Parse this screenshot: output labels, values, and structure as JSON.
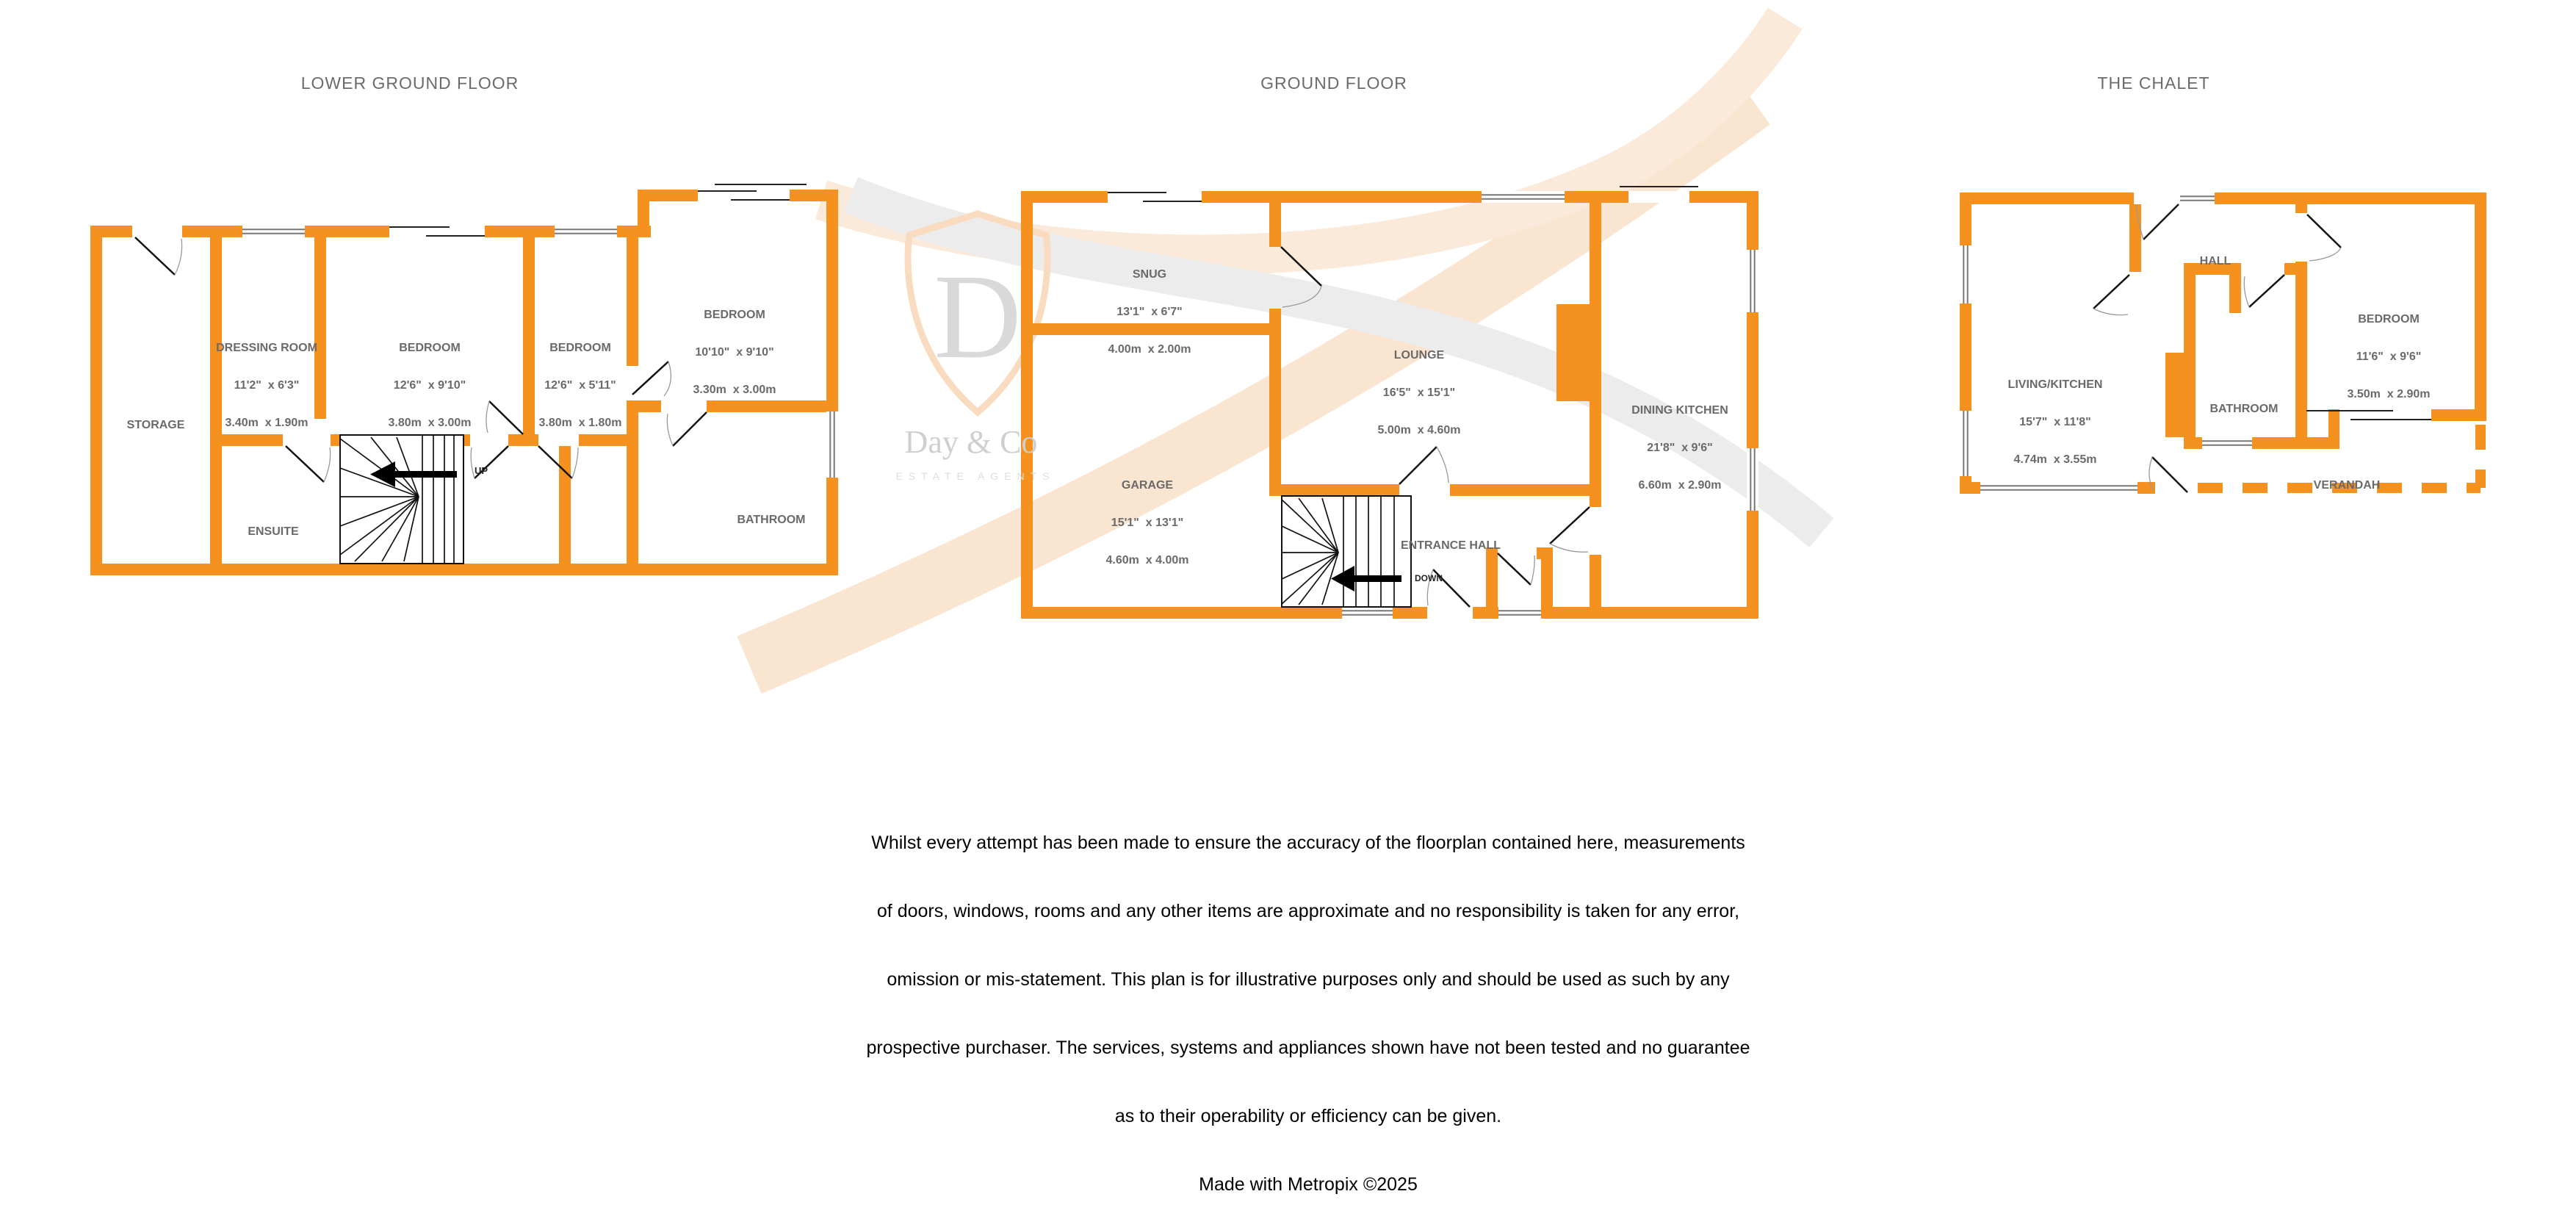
{
  "floors": [
    {
      "id": "lower",
      "title": "LOWER GROUND FLOOR"
    },
    {
      "id": "ground",
      "title": "GROUND FLOOR"
    },
    {
      "id": "chalet",
      "title": "THE CHALET"
    }
  ],
  "rooms": {
    "storage": {
      "name": "STORAGE"
    },
    "dressing_room": {
      "name": "DRESSING ROOM",
      "imperial": "11'2\"  x 6'3\"",
      "metric": "3.40m  x 1.90m"
    },
    "bedroom1": {
      "name": "BEDROOM",
      "imperial": "12'6\"  x 9'10\"",
      "metric": "3.80m  x 3.00m"
    },
    "bedroom2": {
      "name": "BEDROOM",
      "imperial": "12'6\"  x 5'11\"",
      "metric": "3.80m  x 1.80m"
    },
    "bedroom3": {
      "name": "BEDROOM",
      "imperial": "10'10\"  x 9'10\"",
      "metric": "3.30m  x 3.00m"
    },
    "ensuite": {
      "name": "ENSUITE"
    },
    "bathroom_lower": {
      "name": "BATHROOM"
    },
    "snug": {
      "name": "SNUG",
      "imperial": "13'1\"  x 6'7\"",
      "metric": "4.00m  x 2.00m"
    },
    "garage": {
      "name": "GARAGE",
      "imperial": "15'1\"  x 13'1\"",
      "metric": "4.60m  x 4.00m"
    },
    "lounge": {
      "name": "LOUNGE",
      "imperial": "16'5\"  x 15'1\"",
      "metric": "5.00m  x 4.60m"
    },
    "dining_kitchen": {
      "name": "DINING KITCHEN",
      "imperial": "21'8\"  x 9'6\"",
      "metric": "6.60m  x 2.90m"
    },
    "entrance_hall": {
      "name": "ENTRANCE HALL"
    },
    "hall_chalet": {
      "name": "HALL"
    },
    "living_kitchen": {
      "name": "LIVING/KITCHEN",
      "imperial": "15'7\"  x 11'8\"",
      "metric": "4.74m  x 3.55m"
    },
    "bathroom_chalet": {
      "name": "BATHROOM"
    },
    "bedroom_chalet": {
      "name": "BEDROOM",
      "imperial": "11'6\"  x 9'6\"",
      "metric": "3.50m  x 2.90m"
    },
    "verandah": {
      "name": "VERANDAH"
    }
  },
  "stairs": {
    "up": "UP",
    "down": "DOWN"
  },
  "watermark": {
    "initial": "D",
    "brand": "Day & Co",
    "tagline": "ESTATE AGENTS"
  },
  "disclaimer": {
    "lines": [
      "Whilst every attempt has been made to ensure the accuracy of the floorplan contained here, measurements",
      "of doors, windows, rooms and any other items are approximate and no responsibility is taken for any error,",
      "omission or mis-statement. This plan is for illustrative purposes only and should be used as such by any",
      "prospective purchaser. The services, systems and appliances shown have not been tested and no guarantee",
      "as to their operability or efficiency can be given."
    ],
    "credit": "Made with Metropix ©2025"
  },
  "colors": {
    "wall": "#F5911E",
    "label": "#6A6A6A",
    "title": "#6B6B6B",
    "watermark_gray": "#D9D9D9",
    "watermark_orange": "#F9DCC0"
  }
}
